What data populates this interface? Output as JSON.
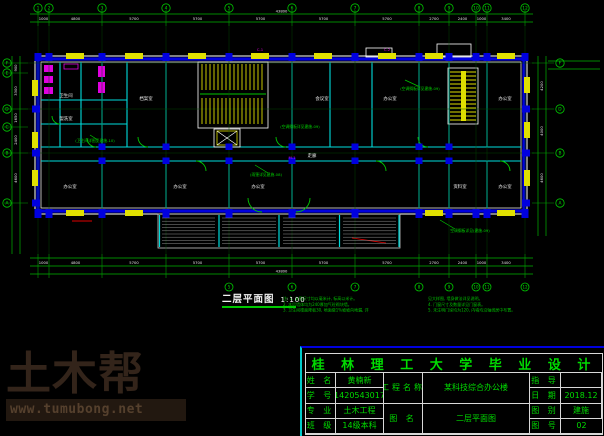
{
  "colors": {
    "background": "#000000",
    "dimension_green": "#00b400",
    "wall_blue": "#0000e0",
    "partition_cyan": "#00dcdc",
    "window_yellow": "#e0e000",
    "fixture_magenta": "#e000e0",
    "text_white": "#f0f0f0",
    "titleblock_green": "#00dc00",
    "watermark_brown": "#33241a",
    "accent_red": "#e00000"
  },
  "watermark": {
    "brand": "土木帮",
    "url": "www.tumubong.net"
  },
  "plan": {
    "caption": {
      "text": "二层平面图",
      "scale": "1:100"
    },
    "grid_top": [
      "1",
      "2",
      "3",
      "4",
      "5",
      "6",
      "7",
      "8",
      "9",
      "10",
      "11",
      "12"
    ],
    "grid_bottom": [
      "5",
      "6",
      "7",
      "8",
      "9",
      "10",
      "11",
      "12"
    ],
    "grid_left": [
      "F",
      "E",
      "D",
      "C",
      "B",
      "A"
    ],
    "grid_right": [
      "F",
      "D",
      "B",
      "A"
    ],
    "dims_top": [
      "1000",
      "4800",
      "5700",
      "5700",
      "5700",
      "5700",
      "5700",
      "2700",
      "2400",
      "1000",
      "3400"
    ],
    "dims_top_total": "43800",
    "dims_bottom": [
      "1000",
      "4800",
      "5700",
      "5700",
      "5700",
      "5700",
      "5700",
      "2700",
      "2400",
      "1000",
      "3400"
    ],
    "dims_bottom_total": "43800",
    "dims_left": [
      "900",
      "3300",
      "1650",
      "2400",
      "4600"
    ],
    "dims_right": [
      "4200",
      "4000",
      "4600"
    ],
    "rooms": [
      {
        "label": "卫生间",
        "x": 66,
        "y": 97
      },
      {
        "label": "盥洗室",
        "x": 66,
        "y": 120
      },
      {
        "label": "办公室",
        "x": 70,
        "y": 188
      },
      {
        "label": "档案室",
        "x": 146,
        "y": 100
      },
      {
        "label": "办公室",
        "x": 180,
        "y": 188
      },
      {
        "label": "会议室",
        "x": 322,
        "y": 100
      },
      {
        "label": "办公室",
        "x": 258,
        "y": 188
      },
      {
        "label": "走廊",
        "x": 312,
        "y": 157
      },
      {
        "label": "办公室",
        "x": 390,
        "y": 100
      },
      {
        "label": "资料室",
        "x": 460,
        "y": 188
      },
      {
        "label": "办公室",
        "x": 505,
        "y": 100
      },
      {
        "label": "办公室",
        "x": 505,
        "y": 188
      }
    ],
    "annotations": [
      {
        "text": "(雨篷详见建施-08)",
        "x": 266,
        "y": 176
      },
      {
        "text": "(空调搁板详见建施-09)",
        "x": 420,
        "y": 90
      },
      {
        "text": "(空调搁板详见建施-09)",
        "x": 300,
        "y": 128
      },
      {
        "text": "空调搁板详见(建施-09)",
        "x": 470,
        "y": 232
      },
      {
        "text": "(卫生间详图见建施-10)",
        "x": 95,
        "y": 142
      }
    ],
    "marks": [
      {
        "text": "C-1",
        "x": 260,
        "y": 51
      },
      {
        "text": "C-2",
        "x": 387,
        "y": 51
      },
      {
        "text": "M-1",
        "x": 292,
        "y": 159
      }
    ],
    "notes_left": [
      "注: 1. 本图尺寸均以毫米计, 标高以米计。",
      "2. 本层墙体均为240厚加气砼砌块墙。",
      "3. 卫生间楼面降板30, 地面做1%坡坡向地漏, 详"
    ],
    "notes_right": [
      "见大样图, 墙身做法详见说明。",
      "4. 门窗尺寸及数量详见门窗表。",
      "5. 未注明门垛均为120, 内墙均沿轴线居中布置。"
    ]
  },
  "titleblock": {
    "title": "桂 林 理 工 大 学 毕 业 设 计",
    "name_label": "姓 名",
    "name_value": "黄楠新",
    "id_label": "学 号",
    "id_value": "1420543017",
    "major_label": "专 业",
    "major_value": "土木工程",
    "class_label": "班 级",
    "class_value": "14级本科",
    "project_label": "工程名称",
    "project_value": "某科技综合办公楼",
    "drawing_label": "图 名",
    "drawing_value": "二层平面图",
    "advisor_label": "指 导",
    "advisor_value": "",
    "date_label": "日 期",
    "date_value": "2018.12",
    "category_label": "图 别",
    "category_value": "建施",
    "number_label": "图 号",
    "number_value": "02"
  }
}
